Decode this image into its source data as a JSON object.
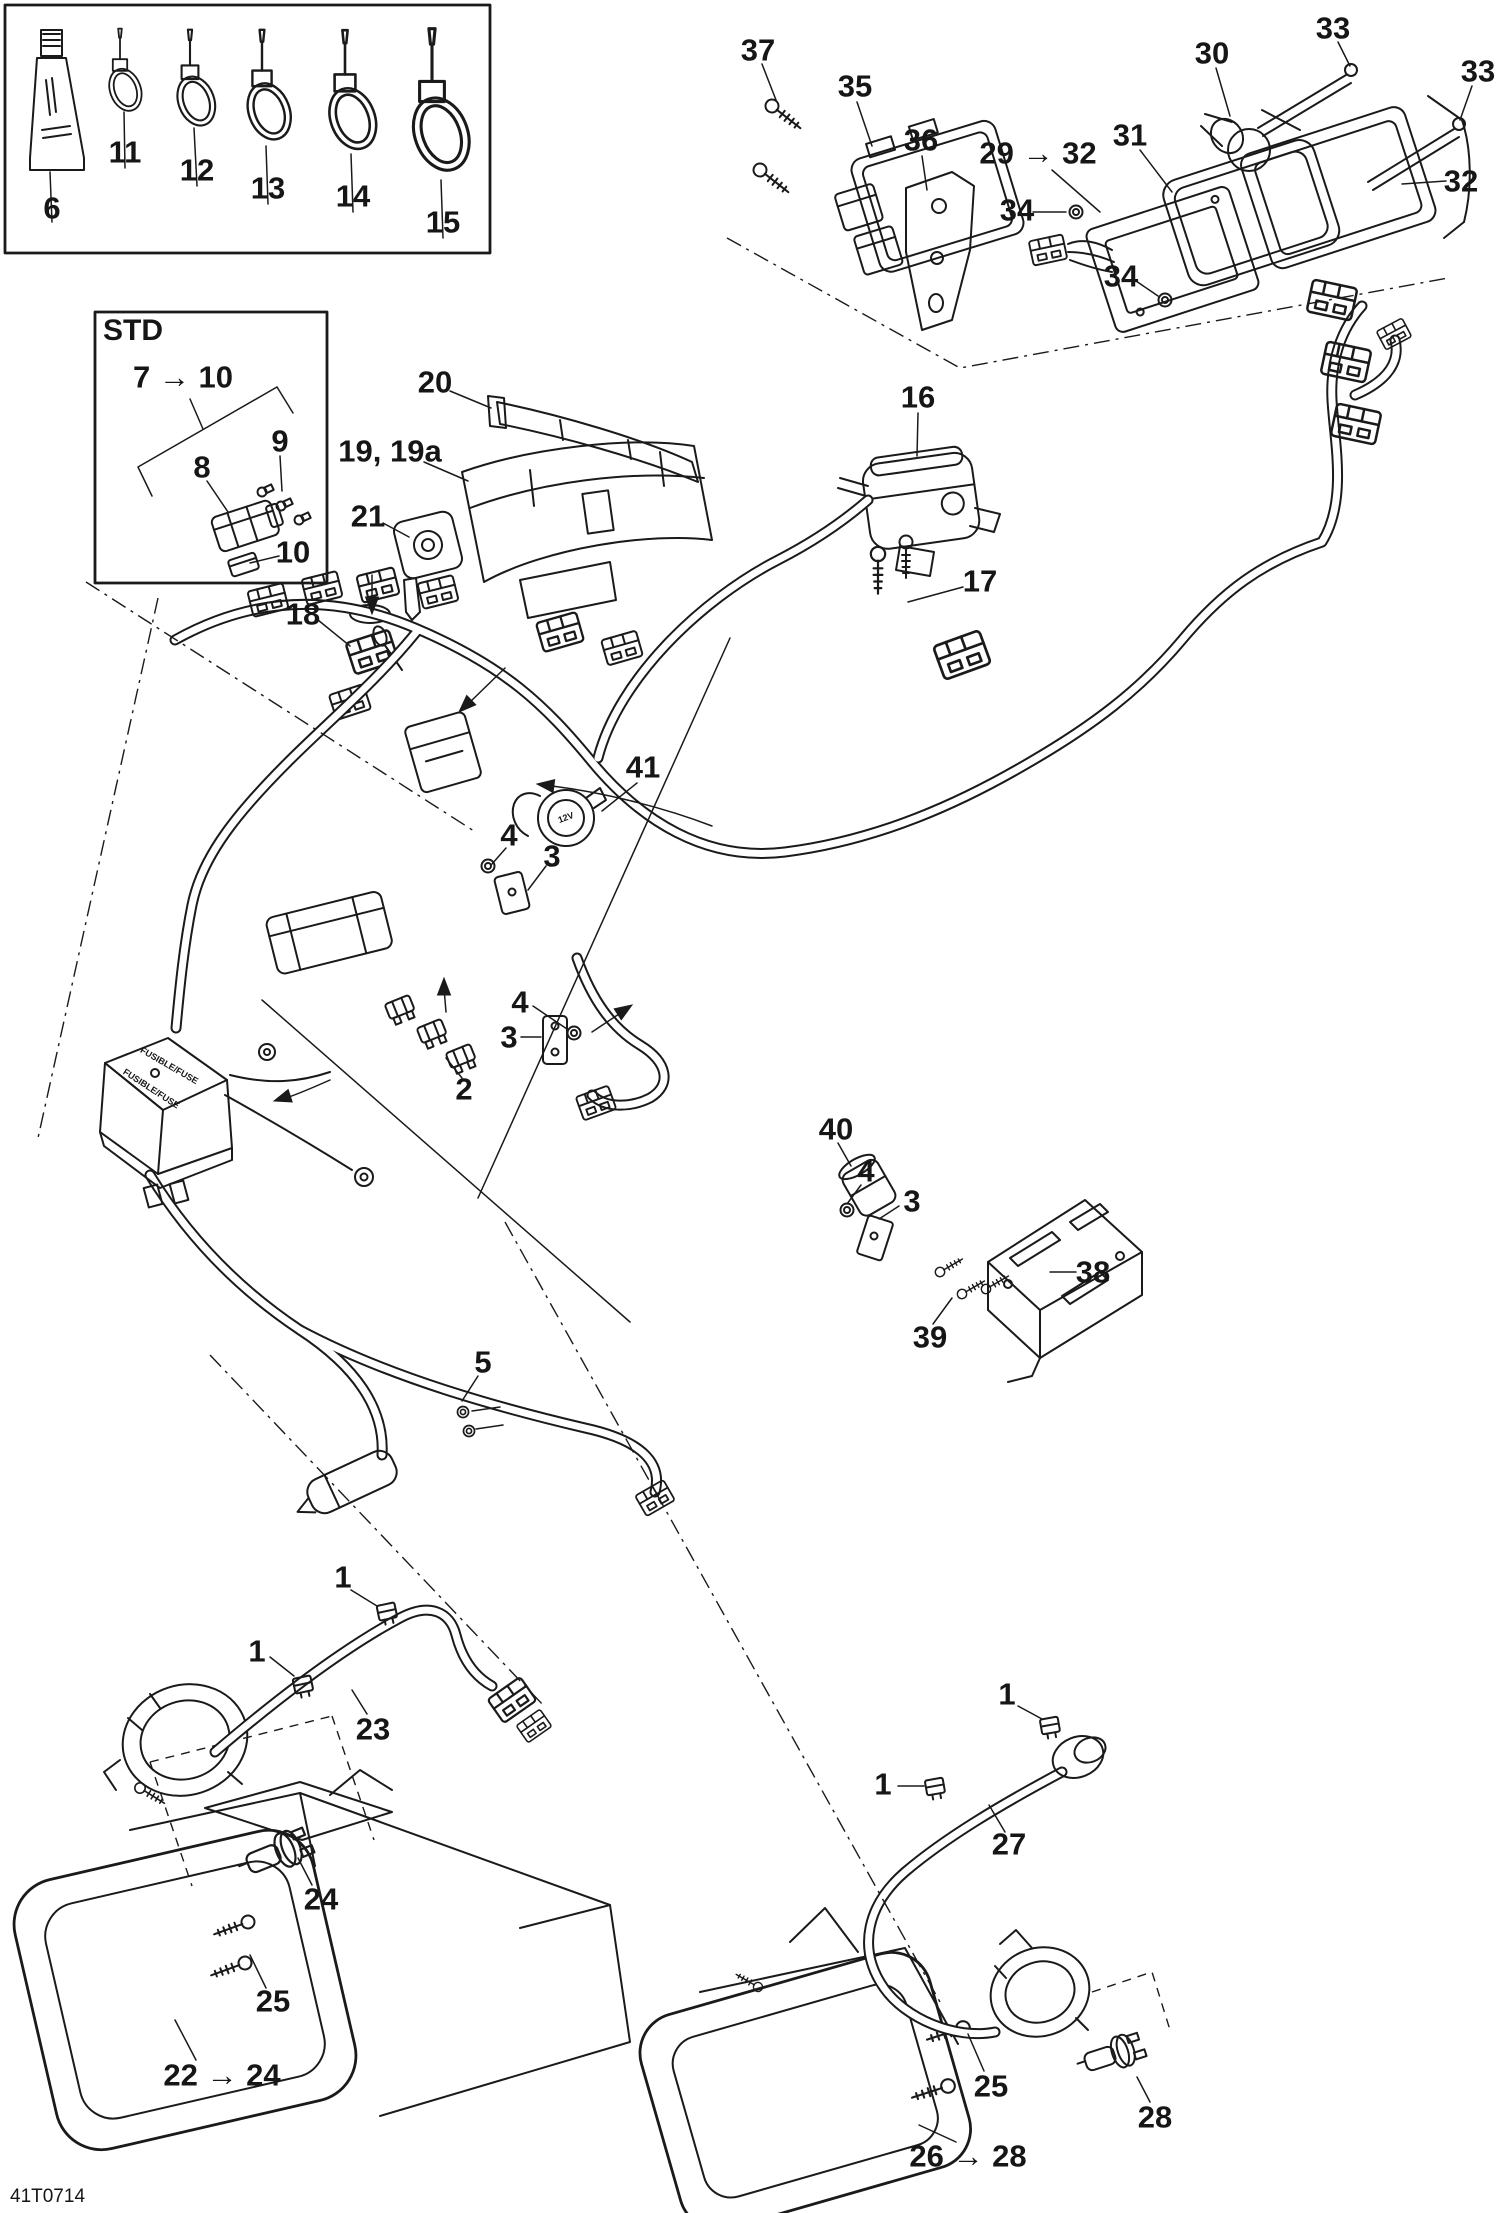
{
  "diagram": {
    "drawing_code": "41T0714",
    "description": "Electrical system wiring harness exploded parts diagram",
    "fuse_box_text": "FUSIBLE/FUSE",
    "socket_marking": "12V",
    "inset_label": "STD"
  },
  "callouts": [
    {
      "name": "callout-6",
      "text": "6",
      "x": 52,
      "y": 208
    },
    {
      "name": "callout-11",
      "text": "11",
      "x": 125,
      "y": 152
    },
    {
      "name": "callout-12",
      "text": "12",
      "x": 197,
      "y": 170
    },
    {
      "name": "callout-13",
      "text": "13",
      "x": 268,
      "y": 188
    },
    {
      "name": "callout-14",
      "text": "14",
      "x": 353,
      "y": 196
    },
    {
      "name": "callout-15",
      "text": "15",
      "x": 443,
      "y": 222
    },
    {
      "name": "callout-37",
      "text": "37",
      "x": 758,
      "y": 50
    },
    {
      "name": "callout-35",
      "text": "35",
      "x": 855,
      "y": 86
    },
    {
      "name": "callout-36",
      "text": "36",
      "x": 921,
      "y": 140
    },
    {
      "name": "callout-29-32",
      "text": "29 → 32",
      "x": 1038,
      "y": 153
    },
    {
      "name": "callout-31",
      "text": "31",
      "x": 1130,
      "y": 135
    },
    {
      "name": "callout-30",
      "text": "30",
      "x": 1212,
      "y": 53
    },
    {
      "name": "callout-33a",
      "text": "33",
      "x": 1333,
      "y": 28
    },
    {
      "name": "callout-33b",
      "text": "33",
      "x": 1478,
      "y": 71
    },
    {
      "name": "callout-32",
      "text": "32",
      "x": 1461,
      "y": 181
    },
    {
      "name": "callout-34a",
      "text": "34",
      "x": 1017,
      "y": 210
    },
    {
      "name": "callout-34b",
      "text": "34",
      "x": 1121,
      "y": 276
    },
    {
      "name": "callout-std",
      "text": "STD",
      "x": 133,
      "y": 331,
      "fs": 30
    },
    {
      "name": "callout-7-10",
      "text": "7 → 10",
      "x": 183,
      "y": 377
    },
    {
      "name": "callout-8",
      "text": "8",
      "x": 202,
      "y": 467
    },
    {
      "name": "callout-9",
      "text": "9",
      "x": 280,
      "y": 441
    },
    {
      "name": "callout-10",
      "text": "10",
      "x": 293,
      "y": 552
    },
    {
      "name": "callout-20",
      "text": "20",
      "x": 435,
      "y": 382
    },
    {
      "name": "callout-19-19a",
      "text": "19, 19a",
      "x": 390,
      "y": 451
    },
    {
      "name": "callout-21",
      "text": "21",
      "x": 368,
      "y": 516
    },
    {
      "name": "callout-18",
      "text": "18",
      "x": 303,
      "y": 614
    },
    {
      "name": "callout-16",
      "text": "16",
      "x": 918,
      "y": 397
    },
    {
      "name": "callout-17",
      "text": "17",
      "x": 980,
      "y": 581
    },
    {
      "name": "callout-41",
      "text": "41",
      "x": 643,
      "y": 767
    },
    {
      "name": "callout-4a",
      "text": "4",
      "x": 509,
      "y": 835
    },
    {
      "name": "callout-3a",
      "text": "3",
      "x": 552,
      "y": 856
    },
    {
      "name": "callout-4b",
      "text": "4",
      "x": 520,
      "y": 1002
    },
    {
      "name": "callout-3b",
      "text": "3",
      "x": 509,
      "y": 1037
    },
    {
      "name": "callout-2",
      "text": "2",
      "x": 464,
      "y": 1089
    },
    {
      "name": "callout-40",
      "text": "40",
      "x": 836,
      "y": 1129
    },
    {
      "name": "callout-4c",
      "text": "4",
      "x": 866,
      "y": 1171
    },
    {
      "name": "callout-3c",
      "text": "3",
      "x": 912,
      "y": 1201
    },
    {
      "name": "callout-38",
      "text": "38",
      "x": 1093,
      "y": 1272
    },
    {
      "name": "callout-39",
      "text": "39",
      "x": 930,
      "y": 1337
    },
    {
      "name": "callout-5",
      "text": "5",
      "x": 483,
      "y": 1362
    },
    {
      "name": "callout-1a",
      "text": "1",
      "x": 343,
      "y": 1577
    },
    {
      "name": "callout-1b",
      "text": "1",
      "x": 257,
      "y": 1651
    },
    {
      "name": "callout-23",
      "text": "23",
      "x": 373,
      "y": 1729
    },
    {
      "name": "callout-24",
      "text": "24",
      "x": 321,
      "y": 1899
    },
    {
      "name": "callout-25a",
      "text": "25",
      "x": 273,
      "y": 2001
    },
    {
      "name": "callout-22-24",
      "text": "22 → 24",
      "x": 222,
      "y": 2075
    },
    {
      "name": "callout-1c",
      "text": "1",
      "x": 1007,
      "y": 1694
    },
    {
      "name": "callout-1d",
      "text": "1",
      "x": 883,
      "y": 1784
    },
    {
      "name": "callout-27",
      "text": "27",
      "x": 1009,
      "y": 1844
    },
    {
      "name": "callout-25b",
      "text": "25",
      "x": 991,
      "y": 2086
    },
    {
      "name": "callout-28",
      "text": "28",
      "x": 1155,
      "y": 2117
    },
    {
      "name": "callout-26-28",
      "text": "26 → 28",
      "x": 968,
      "y": 2156
    },
    {
      "name": "fusebox-text-1",
      "text": "FUSIBLE/FUSE",
      "x": 169,
      "y": 1066,
      "fs": 9,
      "rot": 30,
      "w": 700
    },
    {
      "name": "fusebox-text-2",
      "text": "FUSIBLE/FUSE",
      "x": 151,
      "y": 1089,
      "fs": 9,
      "rot": 33,
      "w": 700
    },
    {
      "name": "socket-12v-marking",
      "text": "12V",
      "x": 566,
      "y": 818,
      "fs": 9,
      "rot": -20,
      "w": 700
    }
  ]
}
